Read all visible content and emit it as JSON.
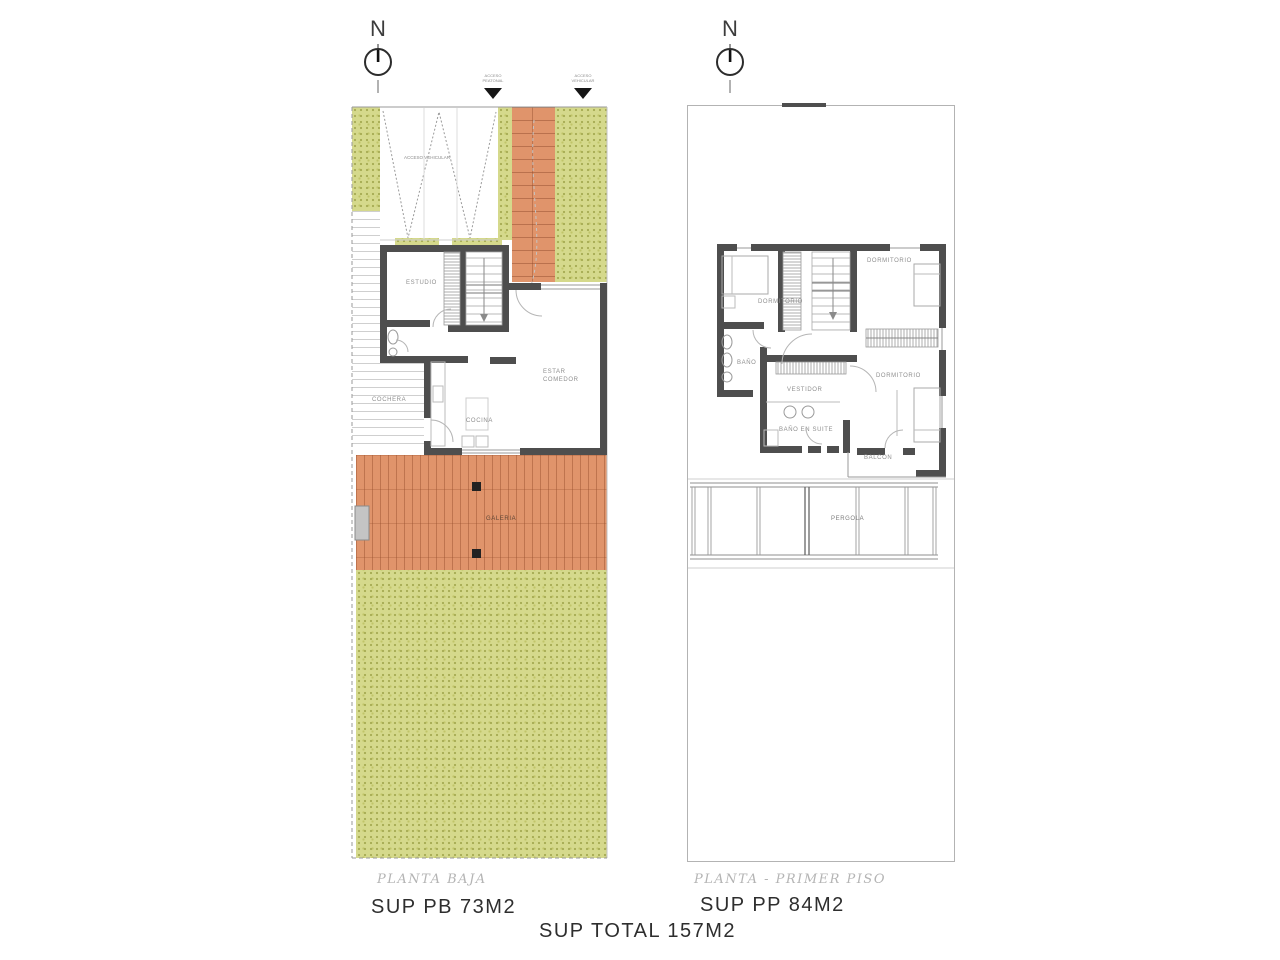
{
  "document": {
    "type_note": "architectural floor plan sheet",
    "total_area_label": "SUP TOTAL 157M2"
  },
  "colors": {
    "grass": "#d5d98c",
    "grass_speckle": "#a8ad55",
    "deck": "#e0946b",
    "wall": "#4e4e4e",
    "thin_line": "#9a9a9a",
    "title_gray": "#b4b4b4",
    "ink": "#2e2e2e"
  },
  "compass": {
    "letter": "N"
  },
  "markers": [
    {
      "line1": "ACCESO",
      "line2": "PEATONAL"
    },
    {
      "line1": "ACCESO",
      "line2": "VEHICULAR"
    }
  ],
  "driveway_label": "ACCESO VEHICULAR",
  "plan_left": {
    "title": "PLANTA BAJA",
    "area": "SUP PB 73M2",
    "rooms": {
      "estudio": "ESTUDIO",
      "estar_line1": "ESTAR",
      "estar_line2": "COMEDOR",
      "cocina": "COCINA",
      "cochera": "COCHERA",
      "galeria": "GALERIA"
    }
  },
  "plan_right": {
    "title": "PLANTA - PRIMER PISO",
    "area": "SUP PP 84M2",
    "rooms": {
      "dorm1": "DORMITORIO",
      "dorm2": "DORMITORIO",
      "bano": "BAÑO",
      "vestidor": "VESTIDOR",
      "bano_suite": "BAÑO EN SUITE",
      "dorm3": "DORMITORIO",
      "balcon": "BALCON",
      "pergola": "PERGOLA"
    }
  }
}
